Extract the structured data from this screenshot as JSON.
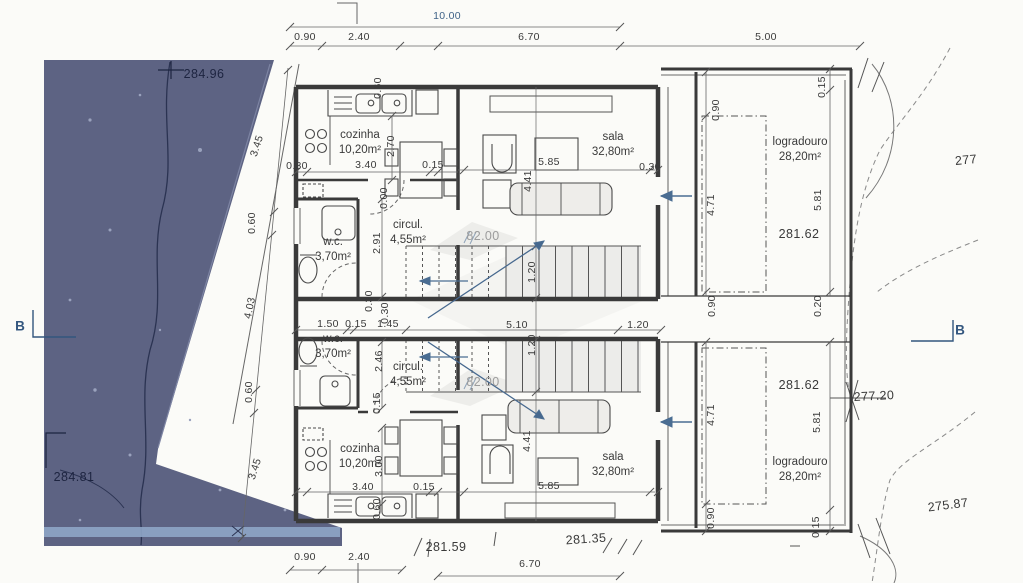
{
  "document": {
    "type": "scanned architectural floor plan, two mirrored dwelling units with site survey",
    "colors": {
      "paper": "#fbfbf8",
      "ink": "#3a3a3a",
      "blue_ink": "#3f6287",
      "terrain_fill": "#5d6383",
      "terrain_light_strip": "#8ea5c6",
      "faded_text": "#9c9c9c",
      "navy_on_terrain": "#1d2440"
    }
  },
  "rooms": [
    {
      "name": "cozinha-upper",
      "label": "cozinha",
      "area": "10,20m²",
      "x": 360,
      "y": 143
    },
    {
      "name": "sala-upper",
      "label": "sala",
      "area": "32,80m²",
      "x": 613,
      "y": 145
    },
    {
      "name": "logradouro-upper",
      "label": "logradouro",
      "area": "28,20m²",
      "x": 800,
      "y": 150
    },
    {
      "name": "wc-upper",
      "label": "w.c.",
      "area": "3,70m²",
      "x": 333,
      "y": 250
    },
    {
      "name": "circul-upper",
      "label": "circul.",
      "area": "4,55m²",
      "x": 408,
      "y": 233
    },
    {
      "name": "wc-lower",
      "label": "w.c.",
      "area": "3,70m²",
      "x": 333,
      "y": 347
    },
    {
      "name": "circul-lower",
      "label": "circul.",
      "area": "4,55m²",
      "x": 408,
      "y": 375
    },
    {
      "name": "cozinha-lower",
      "label": "cozinha",
      "area": "10,20m²",
      "x": 360,
      "y": 457
    },
    {
      "name": "sala-lower",
      "label": "sala",
      "area": "32,80m²",
      "x": 613,
      "y": 465
    },
    {
      "name": "logradouro-lower",
      "label": "logradouro",
      "area": "28,20m²",
      "x": 800,
      "y": 470
    }
  ],
  "dimensions": [
    {
      "t": "10.00",
      "x": 447,
      "y": 16,
      "c": "b"
    },
    {
      "t": "0.90",
      "x": 305,
      "y": 37
    },
    {
      "t": "2.40",
      "x": 359,
      "y": 37
    },
    {
      "t": "6.70",
      "x": 529,
      "y": 37
    },
    {
      "t": "5.00",
      "x": 766,
      "y": 37
    },
    {
      "t": "0.90",
      "x": 305,
      "y": 557
    },
    {
      "t": "2.40",
      "x": 359,
      "y": 557
    },
    {
      "t": "6.70",
      "x": 530,
      "y": 564
    },
    {
      "t": "3.45",
      "x": 257,
      "y": 146,
      "r": -72
    },
    {
      "t": "0.60",
      "x": 252,
      "y": 223,
      "r": -90
    },
    {
      "t": "4.03",
      "x": 250,
      "y": 308,
      "r": -78
    },
    {
      "t": "0.60",
      "x": 249,
      "y": 392,
      "r": -90
    },
    {
      "t": "3.45",
      "x": 255,
      "y": 469,
      "r": -72
    },
    {
      "t": "1.50",
      "x": 328,
      "y": 324
    },
    {
      "t": "0.15",
      "x": 356,
      "y": 324
    },
    {
      "t": "1.45",
      "x": 388,
      "y": 324
    },
    {
      "t": "5.10",
      "x": 517,
      "y": 325
    },
    {
      "t": "1.20",
      "x": 638,
      "y": 325
    },
    {
      "t": "0.30",
      "x": 297,
      "y": 166
    },
    {
      "t": "3.40",
      "x": 366,
      "y": 165
    },
    {
      "t": "0.15",
      "x": 433,
      "y": 165
    },
    {
      "t": "2.70",
      "x": 391,
      "y": 146,
      "r": -90
    },
    {
      "t": "0.60",
      "x": 378,
      "y": 88,
      "r": -90
    },
    {
      "t": "0.00",
      "x": 384,
      "y": 198,
      "r": -90
    },
    {
      "t": "2.91",
      "x": 377,
      "y": 243,
      "r": -90
    },
    {
      "t": "0.30",
      "x": 369,
      "y": 301,
      "r": -90
    },
    {
      "t": "0.30",
      "x": 385,
      "y": 313,
      "r": -90
    },
    {
      "t": "5.85",
      "x": 549,
      "y": 162
    },
    {
      "t": "4.41",
      "x": 528,
      "y": 181,
      "r": -90
    },
    {
      "t": "0.30",
      "x": 650,
      "y": 167
    },
    {
      "t": "1.20",
      "x": 532,
      "y": 272,
      "r": -90
    },
    {
      "t": "1.20",
      "x": 532,
      "y": 345,
      "r": -90
    },
    {
      "t": "2.46",
      "x": 379,
      "y": 361,
      "r": -90
    },
    {
      "t": "0.15",
      "x": 377,
      "y": 403,
      "r": -90
    },
    {
      "t": "3.00",
      "x": 379,
      "y": 466,
      "r": -90
    },
    {
      "t": "3.40",
      "x": 363,
      "y": 487
    },
    {
      "t": "0.15",
      "x": 424,
      "y": 487
    },
    {
      "t": "5.85",
      "x": 549,
      "y": 486
    },
    {
      "t": "4.41",
      "x": 527,
      "y": 441,
      "r": -90
    },
    {
      "t": "0.60",
      "x": 377,
      "y": 509,
      "r": -90
    },
    {
      "t": "0.90",
      "x": 716,
      "y": 110,
      "r": -90
    },
    {
      "t": "0.15",
      "x": 822,
      "y": 87,
      "r": -90
    },
    {
      "t": "4.71",
      "x": 711,
      "y": 205,
      "r": -90
    },
    {
      "t": "5.81",
      "x": 818,
      "y": 200,
      "r": -90
    },
    {
      "t": "0.90",
      "x": 712,
      "y": 306,
      "r": -90
    },
    {
      "t": "0.20",
      "x": 818,
      "y": 306,
      "r": -90
    },
    {
      "t": "4.71",
      "x": 711,
      "y": 415,
      "r": -90
    },
    {
      "t": "5.81",
      "x": 817,
      "y": 422,
      "r": -90
    },
    {
      "t": "0.90",
      "x": 711,
      "y": 518,
      "r": -90
    },
    {
      "t": "0.15",
      "x": 816,
      "y": 527,
      "r": -90
    }
  ],
  "elevations": [
    {
      "t": "284.96",
      "x": 204,
      "y": 74,
      "c": "n"
    },
    {
      "t": "284.81",
      "x": 74,
      "y": 477,
      "c": "n"
    },
    {
      "t": "281.62",
      "x": 799,
      "y": 234
    },
    {
      "t": "281.62",
      "x": 799,
      "y": 385
    },
    {
      "t": "82.00",
      "x": 483,
      "y": 236,
      "c": "g"
    },
    {
      "t": "82.00",
      "x": 483,
      "y": 382,
      "c": "g"
    },
    {
      "t": "281.59",
      "x": 446,
      "y": 547
    },
    {
      "t": "281.35",
      "x": 586,
      "y": 539,
      "r": -4
    },
    {
      "t": "277",
      "x": 966,
      "y": 160,
      "r": -5
    },
    {
      "t": "277.20",
      "x": 874,
      "y": 396,
      "r": -3
    },
    {
      "t": "275.87",
      "x": 948,
      "y": 505,
      "r": -7
    }
  ],
  "section_markers": [
    {
      "t": "B",
      "x": 20,
      "y": 326
    },
    {
      "t": "B",
      "x": 960,
      "y": 330
    }
  ]
}
